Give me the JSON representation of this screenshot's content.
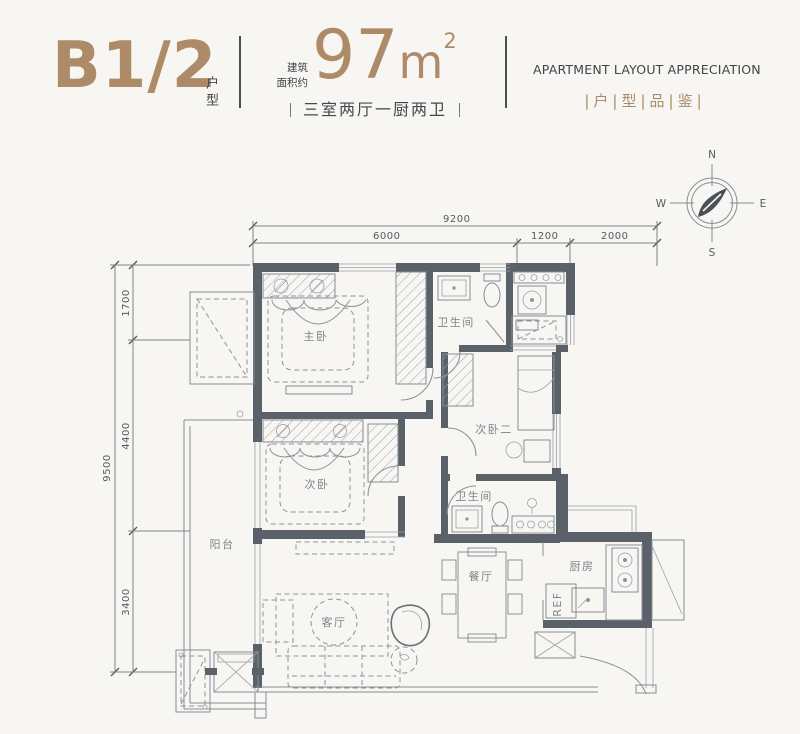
{
  "header": {
    "unit_code": "B1/2",
    "unit_label": "户型",
    "area_prefix_l1": "建筑",
    "area_prefix_l2": "面积约",
    "area_number": "97",
    "area_unit": "m",
    "area_exp": "2",
    "layout_summary": "三室两厅一厨两卫",
    "title_en": "APARTMENT LAYOUT APPRECIATION",
    "title_cn": "|户|型|品|鉴|"
  },
  "compass": {
    "n": "N",
    "e": "E",
    "s": "S",
    "w": "W"
  },
  "dimensions": {
    "top_total": "9200",
    "top_a": "6000",
    "top_b": "1200",
    "top_c": "2000",
    "left_total": "9500",
    "left_a": "1700",
    "left_b": "4400",
    "left_c": "3400"
  },
  "rooms": {
    "master": "主卧",
    "bath_top": "卫生间",
    "bed_second": "次卧",
    "bed_third": "次卧二",
    "balcony": "阳台",
    "bath_mid": "卫生间",
    "dining": "餐厅",
    "kitchen": "厨房",
    "living": "客厅",
    "fridge": "REF"
  },
  "colors": {
    "accent": "#ad8b68",
    "ink": "#3f444a",
    "wall": "#5b6168",
    "line": "#878d94",
    "background": "#f7f6f3"
  }
}
